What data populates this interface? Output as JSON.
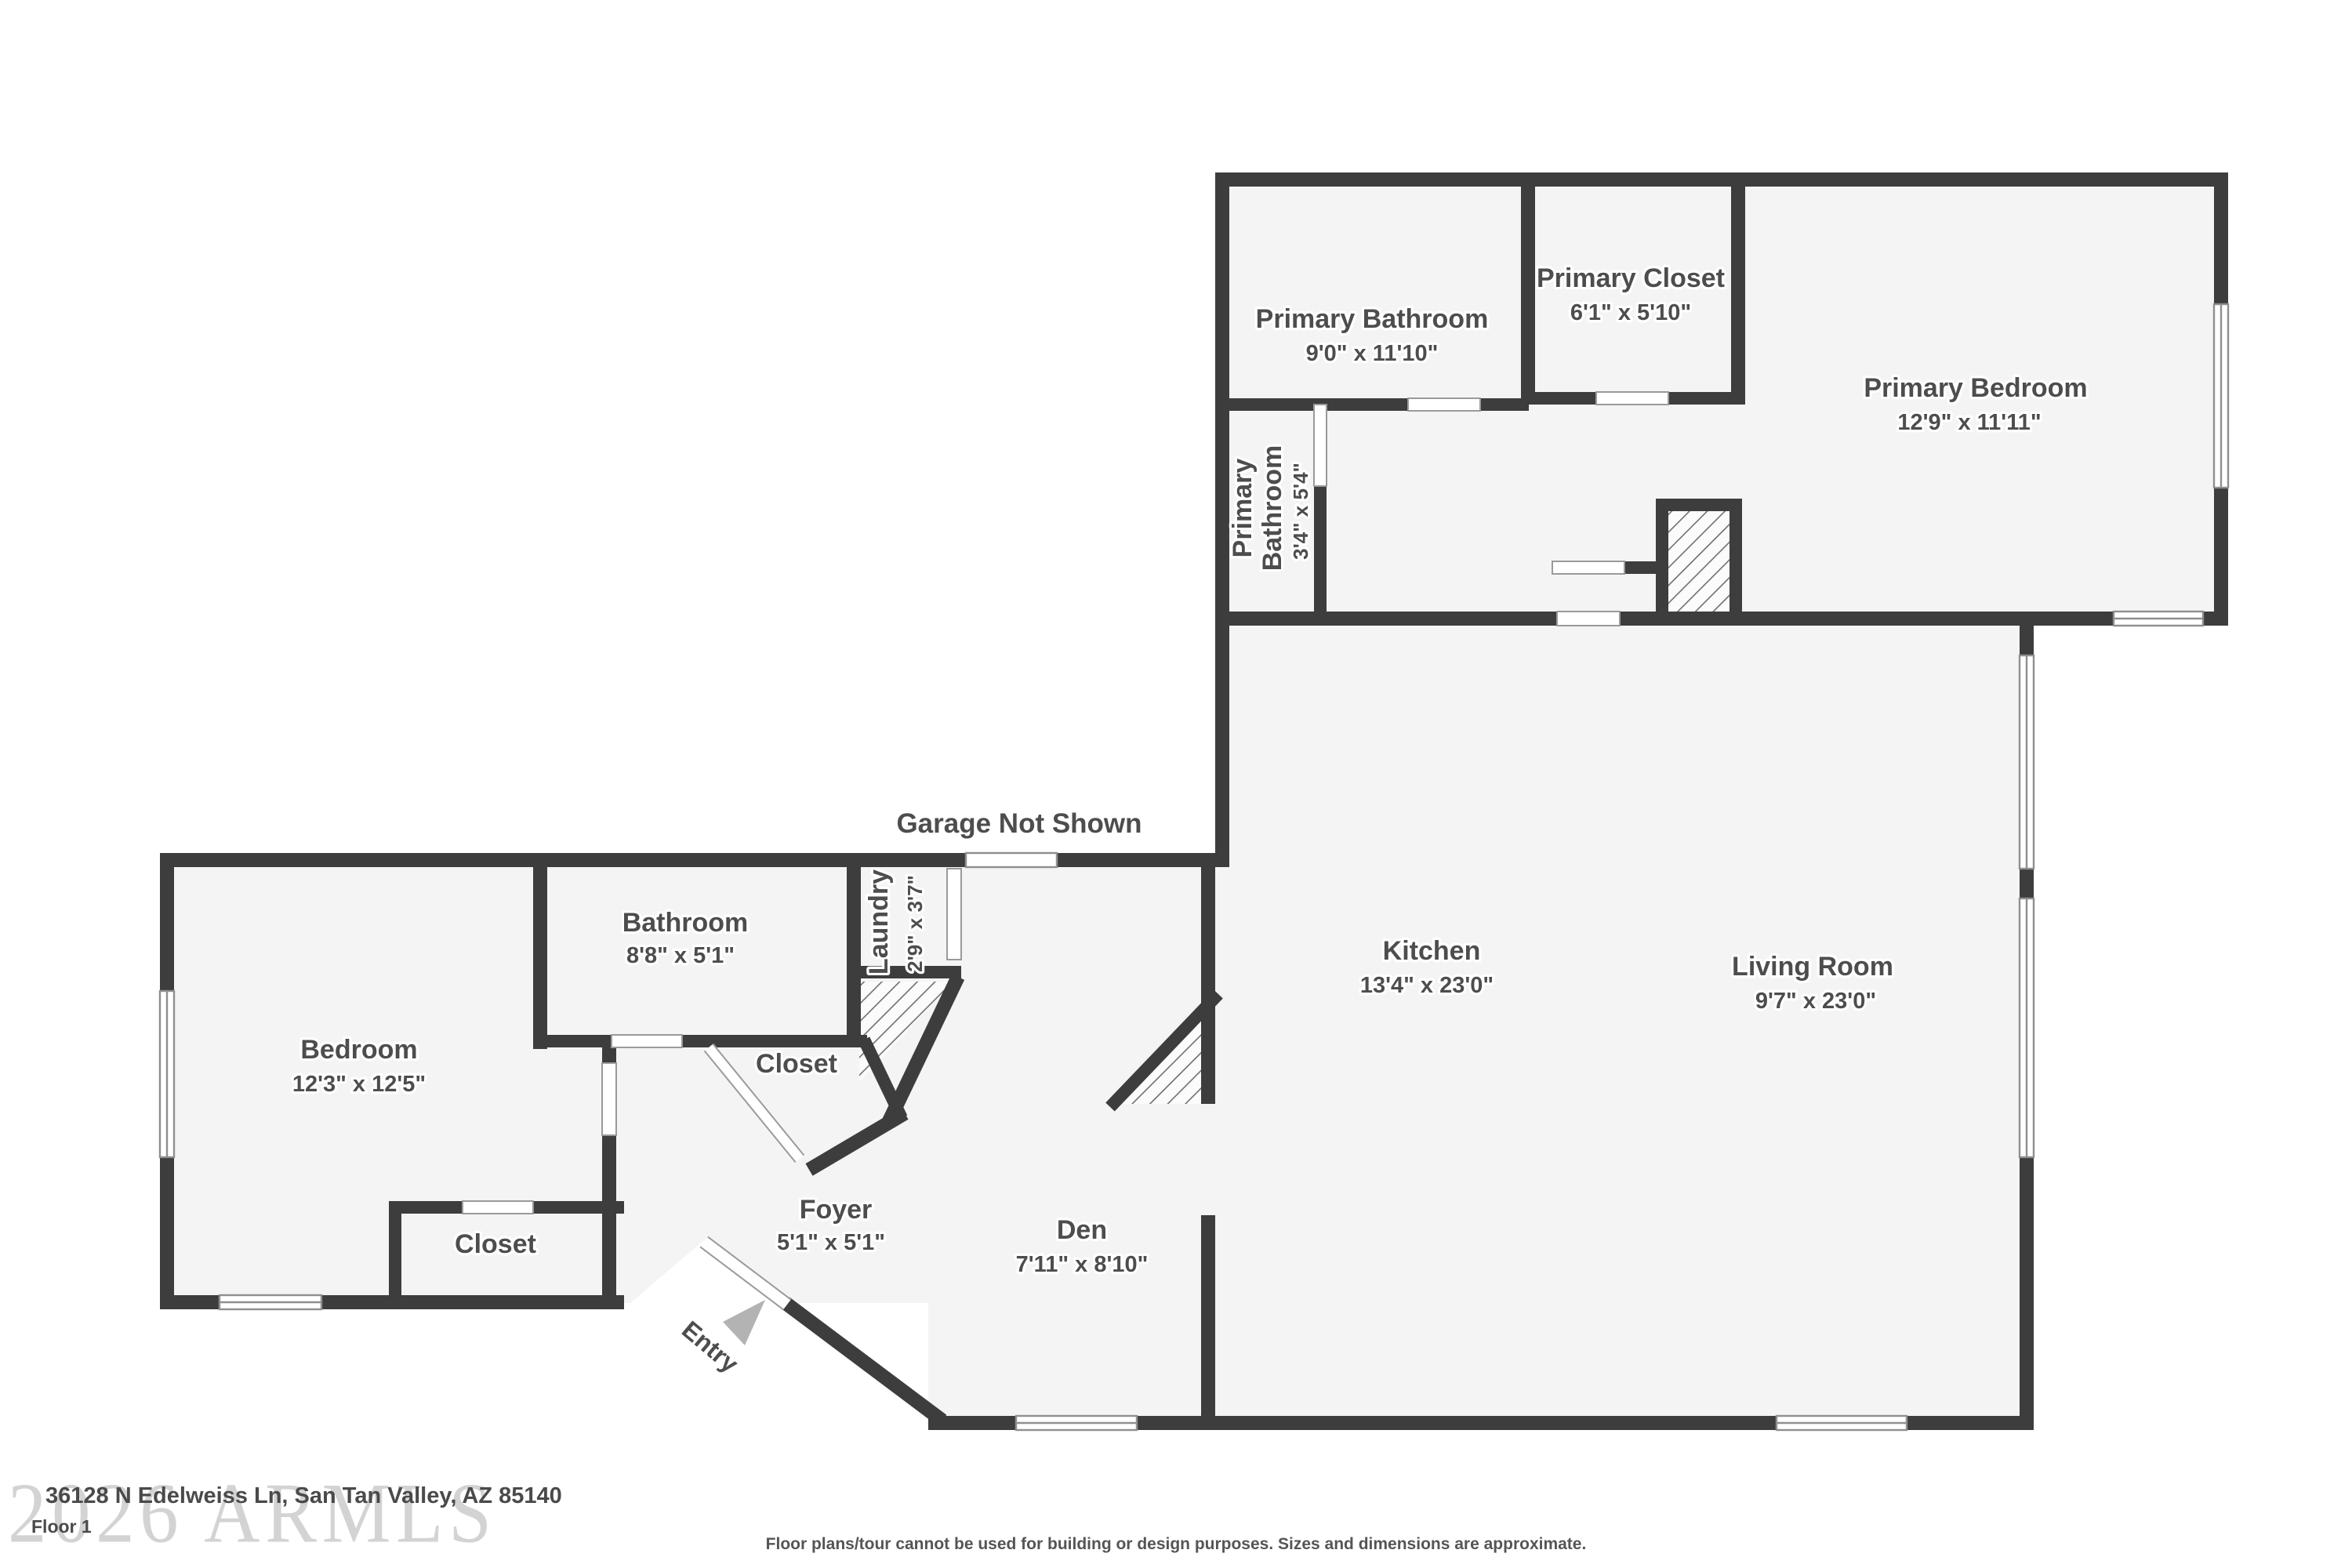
{
  "plan": {
    "garage_note": "Garage Not Shown",
    "entry_label": "Entry",
    "rooms": [
      {
        "name": "Primary Bathroom",
        "dims": "9'0\" x 11'10\""
      },
      {
        "name": "Primary Closet",
        "dims": "6'1\" x 5'10\""
      },
      {
        "name": "Primary Bedroom",
        "dims": "12'9\" x 11'11\""
      },
      {
        "name_lines": [
          "Primary",
          "Bathroom"
        ],
        "dims": "3'4\" x 5'4\""
      },
      {
        "name": "Kitchen",
        "dims": "13'4\" x 23'0\""
      },
      {
        "name": "Living Room",
        "dims": "9'7\" x 23'0\""
      },
      {
        "name": "Bedroom",
        "dims": "12'3\" x 12'5\""
      },
      {
        "name": "Bathroom",
        "dims": "8'8\" x 5'1\""
      },
      {
        "name": "Laundry",
        "dims": "2'9\" x 3'7\""
      },
      {
        "name": "Closet"
      },
      {
        "name": "Closet"
      },
      {
        "name": "Foyer",
        "dims": "5'1\" x 5'1\""
      },
      {
        "name": "Den",
        "dims": "7'11\" x 8'10\""
      }
    ]
  },
  "footer": {
    "watermark": "2026 ARMLS",
    "address": "36128 N Edelweiss Ln, San Tan Valley, AZ 85140",
    "floor_label": "Floor 1",
    "disclaimer": "Floor plans/tour cannot be used for building or design purposes. Sizes and dimensions are approximate."
  },
  "colors": {
    "wall": "#3d3d3d",
    "room_fill": "#f4f4f4",
    "label_text": "#4d4d4d",
    "watermark": "#c9c9c9"
  }
}
